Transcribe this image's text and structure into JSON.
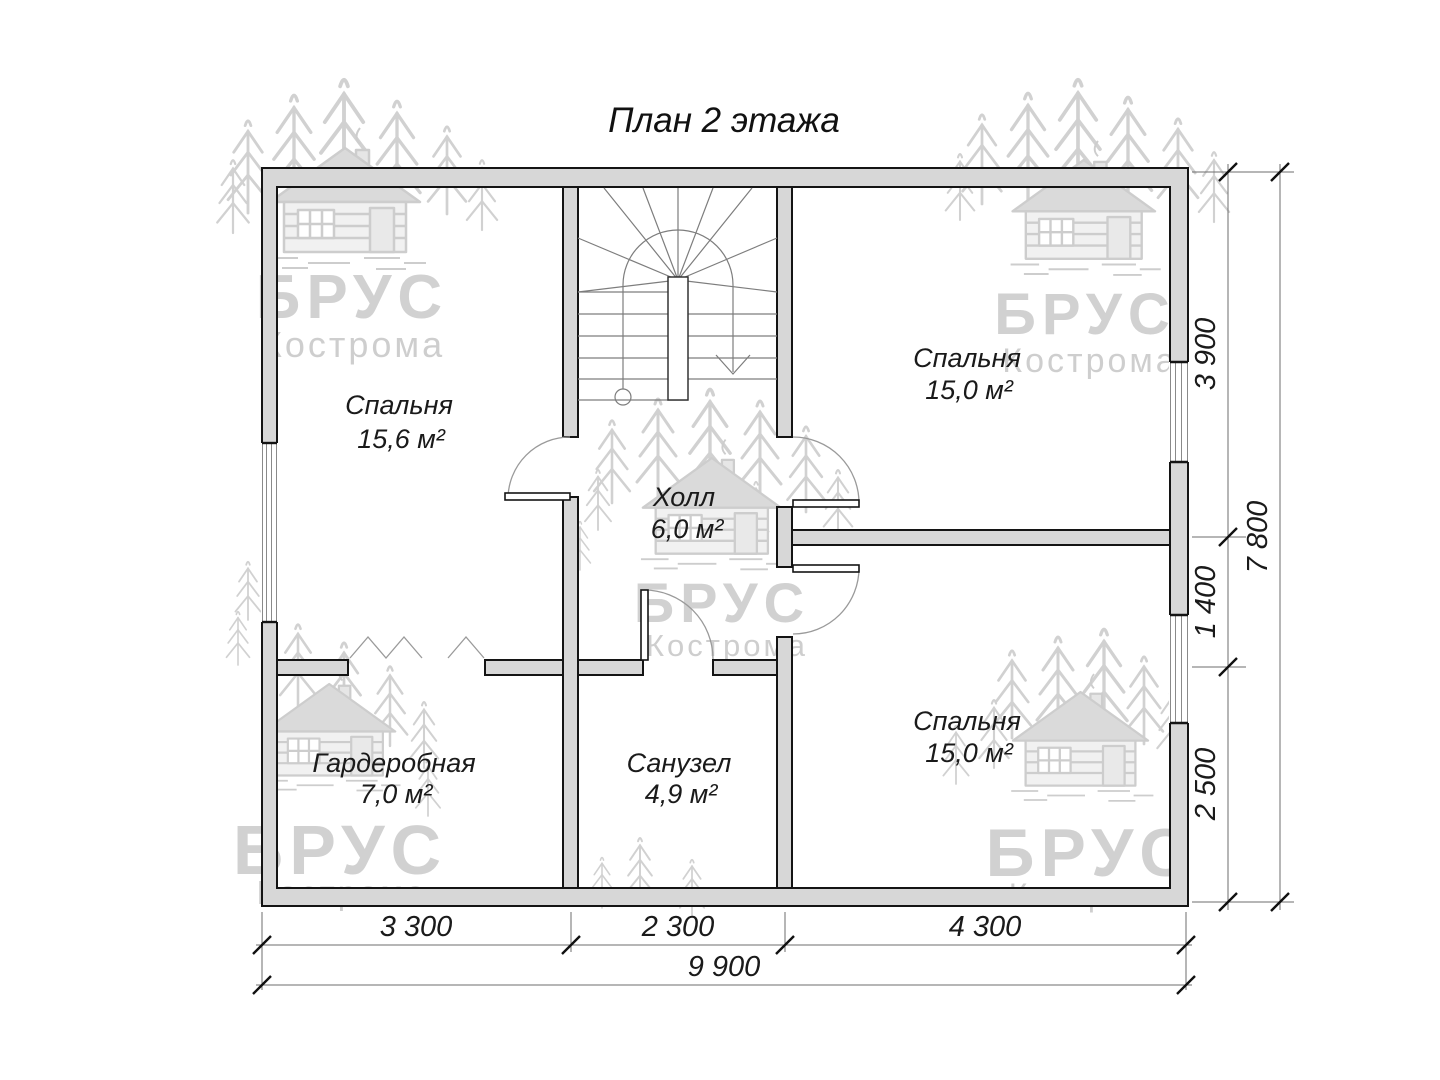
{
  "title": "План 2 этажа",
  "watermark": {
    "brand": "БРУС",
    "city": "Кострома"
  },
  "rooms": {
    "bedroom_top_left": {
      "name": "Спальня",
      "area": "15,6 м²"
    },
    "bedroom_top_right": {
      "name": "Спальня",
      "area": "15,0 м²"
    },
    "hall": {
      "name": "Холл",
      "area": "6,0 м²"
    },
    "wardrobe": {
      "name": "Гардеробная",
      "area": "7,0 м²"
    },
    "bathroom": {
      "name": "Санузел",
      "area": "4,9 м²"
    },
    "bedroom_bottom_right": {
      "name": "Спальня",
      "area": "15,0 м²"
    }
  },
  "dimensions": {
    "right": {
      "segments": [
        "3 900",
        "1 400",
        "2 500"
      ],
      "total": "7 800"
    },
    "bottom": {
      "segments": [
        "3 300",
        "2 300",
        "4 300"
      ],
      "total": "9 900"
    }
  },
  "colors": {
    "wall_fill": "#d7d7d7",
    "outline": "#141414",
    "thin_line": "#7d7d7d",
    "watermark": "#c9c9c9",
    "background": "#ffffff"
  }
}
